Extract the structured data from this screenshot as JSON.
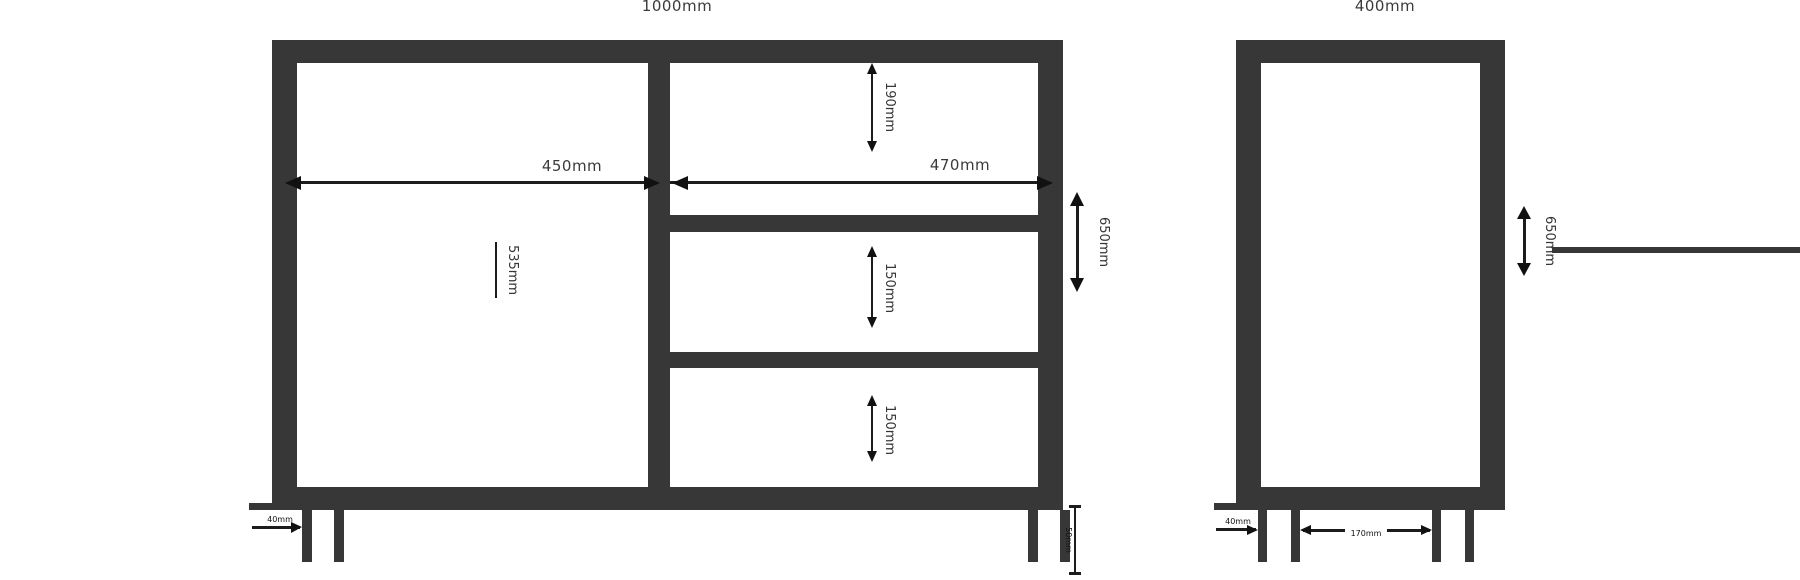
{
  "drawing": {
    "title": "cabinet-dimension-drawing",
    "units": "mm",
    "colors": {
      "line": "#373737",
      "annotation": "#111111",
      "label_background": "#ffffff",
      "page_background": "#ffffff"
    },
    "front_view": {
      "width_label": "1000mm",
      "door_width_label": "450mm",
      "drawer_width_label": "470mm",
      "height_label": "650mm",
      "door_height_label": "535mm",
      "drawer_heights": [
        "190mm",
        "150mm",
        "150mm"
      ],
      "leg_inset_label": "40mm",
      "leg_height_label": "50mm"
    },
    "side_view": {
      "depth_label": "400mm",
      "height_label": "650mm",
      "leg_inset_label": "40mm",
      "leg_gap_label": "170mm"
    }
  }
}
